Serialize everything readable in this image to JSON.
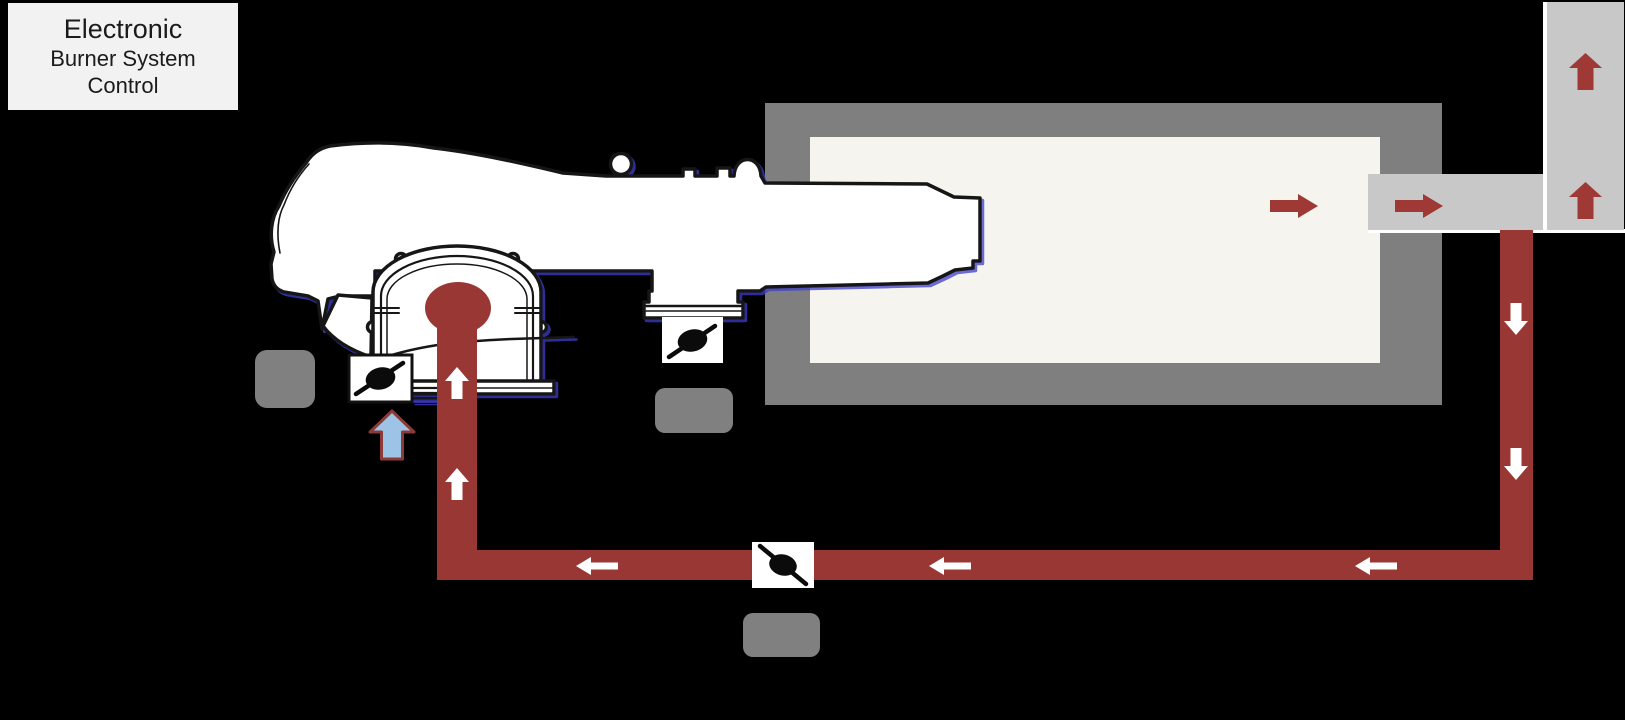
{
  "title_box": {
    "line1": "Electronic",
    "line2": "Burner System",
    "line3": "Control"
  },
  "colors": {
    "background": "#000000",
    "title_bg": "#f2f2f2",
    "title_text": "#1b1b1b",
    "pipe_red": "#993734",
    "arrow_red": "#9e3936",
    "furnace_wall": "#7f7f7f",
    "furnace_interior": "#f6f4ee",
    "duct_gray": "#c8c8c8",
    "label_gray": "#808080",
    "flow_arrow_white": "#ffffff",
    "blue_arrow_fill": "#9dc3e6",
    "blue_arrow_stroke": "#8b3a38",
    "burner_outline": "#161616",
    "outline_blue_shadow": "#3c3cc8"
  },
  "icons": {
    "valve_symbol": "butterfly-valve-icon",
    "white_arrow": "flow-direction-arrow",
    "red_arrow": "hot-gas-flow-arrow",
    "blue_arrow": "combustion-air-inlet-arrow",
    "gray_tag": "blank-label-tag"
  }
}
